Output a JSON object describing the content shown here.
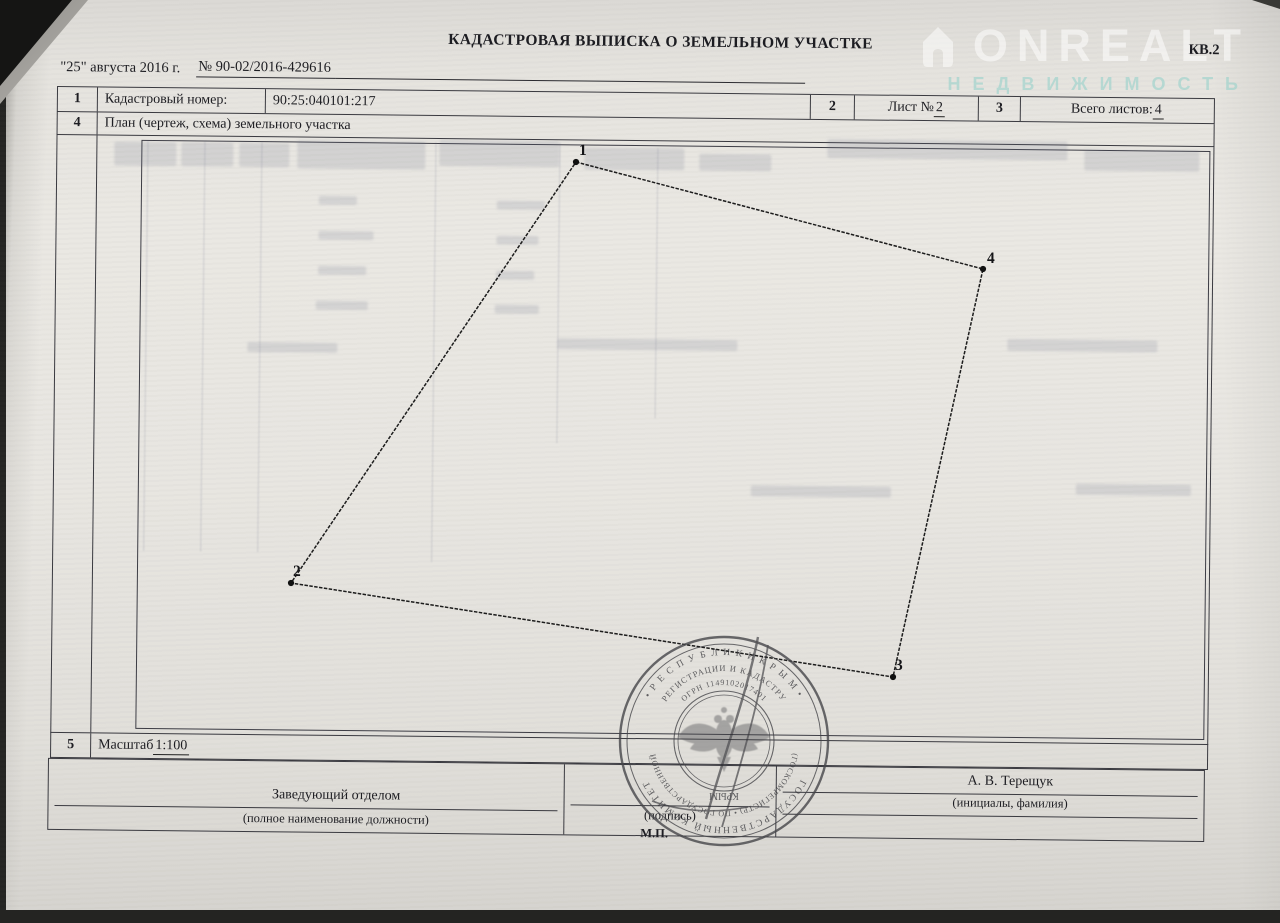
{
  "document": {
    "title": "КАДАСТРОВАЯ ВЫПИСКА О ЗЕМЕЛЬНОМ УЧАСТКЕ",
    "form_code": "КВ.2",
    "date_line": "\"25\" августа 2016 г.",
    "doc_number": "№ 90-02/2016-429616"
  },
  "watermark": {
    "brand": "ONREALT",
    "subtitle": "НЕДВИЖИМОСТЬ",
    "icon": "house-icon",
    "brand_color": "#ffffff",
    "subtitle_color": "#8fd0c9"
  },
  "info_table": {
    "row1_num": "1",
    "cadastral_label": "Кадастровый номер:",
    "cadastral_value": "90:25:040101:217",
    "row2_num": "2",
    "sheet_label": "Лист № ",
    "sheet_value": "2",
    "row3_num": "3",
    "total_label": "Всего листов: ",
    "total_value": "4",
    "row4_num": "4",
    "plan_label": "План (чертеж, схема) земельного участка",
    "row5_num": "5",
    "scale_label": "Масштаб ",
    "scale_value": "1:100"
  },
  "plan": {
    "vertices": [
      {
        "label": "1",
        "x": 576,
        "y": 162,
        "dx": 3,
        "dy": -7
      },
      {
        "label": "4",
        "x": 983,
        "y": 269,
        "dx": 4,
        "dy": -6
      },
      {
        "label": "3",
        "x": 893,
        "y": 677,
        "dx": 2,
        "dy": -7
      },
      {
        "label": "2",
        "x": 291,
        "y": 583,
        "dx": 2,
        "dy": -7
      }
    ]
  },
  "stamp": {
    "ring1_top": "•  Р Е С П У Б Л И К И    К Р Ы М  •",
    "ring1_bottom": "ГОСУДАРСТВЕННЫЙ  КОМИТЕТ",
    "ring2_top": "РЕГИСТРАЦИИ И КАДАСТРУ",
    "ring2_bottom": "(ГОСКОМРЕГИСТР) • ПО ГОСУДАРСТВЕННОЙ",
    "ring3_top": "ОГРН 1149102017401",
    "center_word": "КРЫМ"
  },
  "signature_block": {
    "position_value": "Заведующий отделом",
    "position_caption": "(полное наименование должности)",
    "sign_caption": "(подпись)",
    "name_value": "А. В. Терещук",
    "name_caption": "(инициалы, фамилия)",
    "mp_label": "М.П."
  }
}
